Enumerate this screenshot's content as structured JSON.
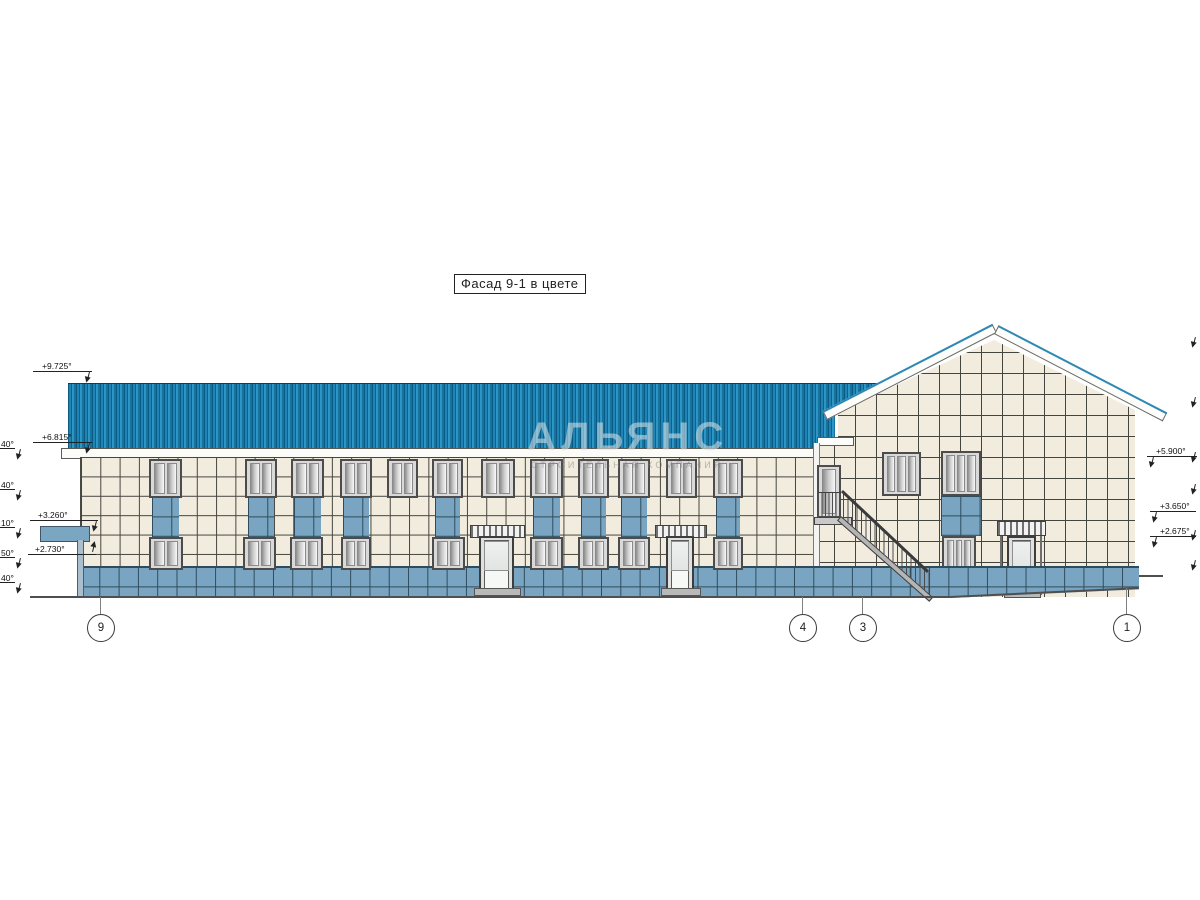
{
  "title_box": {
    "label": "Фасад 9-1 в цвете"
  },
  "watermark": {
    "line1": "АЛЬЯНС",
    "line2": "СТРОИТЕЛЬНАЯ КОМПАНИЯ"
  },
  "colors": {
    "roof_blue": "#1f84b4",
    "tile_cream": "#f1ecdd",
    "tile_blue": "#7aa5c2",
    "barge_blue": "#2e88b4",
    "line_dark": "#45453f"
  },
  "elevation_marks": {
    "left": [
      {
        "value": "+9.725°"
      },
      {
        "value": "+6.815°"
      },
      {
        "value": "+3.260°"
      },
      {
        "value": "+2.730°"
      }
    ],
    "left_clipped": [
      {
        "value": "40°"
      },
      {
        "value": "40°"
      },
      {
        "value": "10°"
      },
      {
        "value": "50°"
      },
      {
        "value": "40°"
      }
    ],
    "right": [
      {
        "value": "+5.900°"
      },
      {
        "value": "+3.650°"
      },
      {
        "value": "+2.675°"
      }
    ]
  },
  "axis_bubbles": [
    {
      "label": "9"
    },
    {
      "label": "4"
    },
    {
      "label": "3"
    },
    {
      "label": "1"
    }
  ]
}
